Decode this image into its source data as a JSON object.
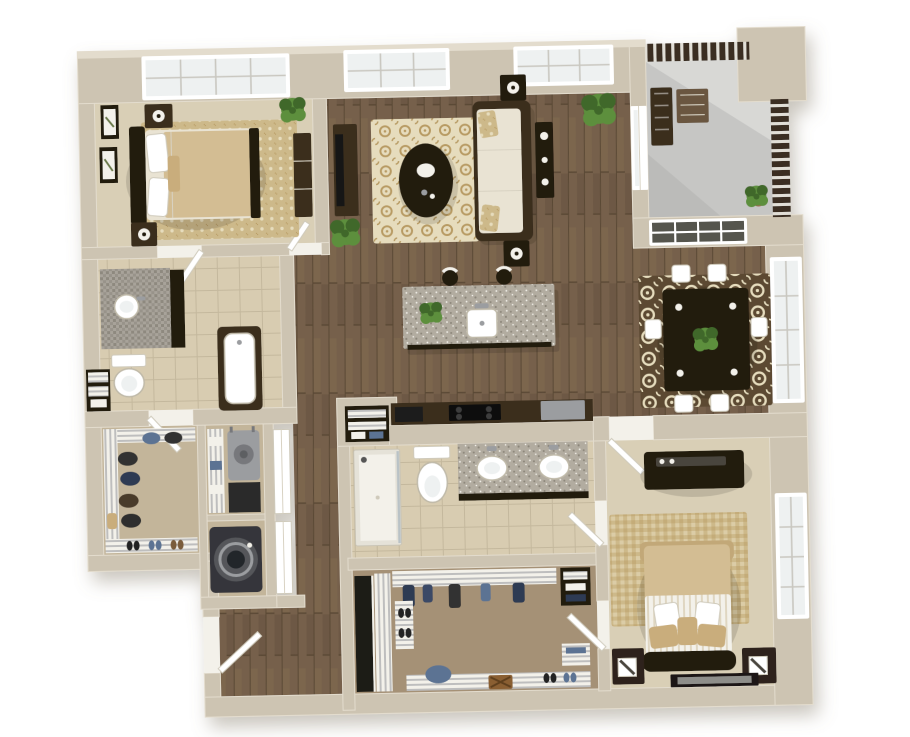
{
  "scene": {
    "type": "3d-floor-plan-render",
    "description": "Top-down 3D render of a two-bedroom, two-bathroom apartment with open living/kitchen/dining area, balcony, walk-in closets and laundry",
    "background": "#ffffff"
  },
  "palette": {
    "wall": "#cdc4b2",
    "wall-light": "#e3dccd",
    "wall-dark": "#a89e8a",
    "wood": "#76614b",
    "wood-dark": "#5a4835",
    "wood-light": "#8b7456",
    "carpet": "#d9cfb6",
    "carpet-2": "#c3b59a",
    "closet-floor": "#a59176",
    "tile": "#d8ccb1",
    "tile-line": "#c4b89d",
    "mosaic-1": "#a8a39a",
    "mosaic-2": "#8e897f",
    "granite": "#b2aca0",
    "granite-dot": "#8c867a",
    "rug-gold": "#cdb98a",
    "rug-cream": "#e6dcbd",
    "rug-brown": "#5c4a31",
    "rug-accent": "#b89b63",
    "sofa-cream": "#e9e3d3",
    "furniture-dark": "#3a2d1f",
    "furniture-darker": "#221a10",
    "plant": "#5d8f3d",
    "plant-dark": "#41682a",
    "balcony-floor": "#c6c6c4",
    "railing": "#3a2f23",
    "white": "#ffffff",
    "off-white": "#f3f1ea",
    "glass": "#eef1f1",
    "glass-dark": "#55544e",
    "steel": "#9b9da0",
    "navy": "#2e3a52",
    "denim": "#5b7393",
    "tan-1": "#d3bd93",
    "tan-2": "#c2a878",
    "tan-3": "#c9ad7c",
    "terracotta": "#9c6b4f",
    "wood-tone": "#6b573f",
    "shadow": "#8a8170"
  },
  "rooms": {
    "bedroom1": {
      "name": "Bedroom 1",
      "floor": "carpet",
      "items": [
        "bed",
        "headboard",
        "pillows",
        "area-rug",
        "nightstand",
        "table-lamp",
        "dresser",
        "wall-art",
        "potted-plant",
        "window"
      ]
    },
    "living": {
      "name": "Living Room",
      "floor": "hardwood",
      "items": [
        "sofa",
        "accent-pillows",
        "coffee-table",
        "console-table",
        "end-table",
        "tv-console",
        "tv",
        "area-rug",
        "potted-plant",
        "window",
        "sliding-door"
      ]
    },
    "kitchen": {
      "name": "Kitchen",
      "floor": "hardwood",
      "items": [
        "island",
        "island-sink",
        "faucet",
        "bar-stool",
        "potted-plant",
        "counter",
        "cooktop",
        "refrigerator"
      ]
    },
    "dining": {
      "name": "Dining Area",
      "floor": "hardwood",
      "items": [
        "dining-table",
        "dining-chair",
        "centerpiece-plant",
        "area-rug",
        "window"
      ]
    },
    "balcony": {
      "name": "Balcony",
      "floor": "concrete",
      "items": [
        "railing",
        "bench",
        "side-table",
        "potted-plant"
      ]
    },
    "bathroom1": {
      "name": "Bathroom 1",
      "floor": "tile",
      "items": [
        "vanity",
        "vessel-sink",
        "toilet",
        "bathtub",
        "linen-shelves",
        "door"
      ]
    },
    "walkInCloset1": {
      "name": "Walk-in Closet 1",
      "floor": "carpet",
      "items": [
        "wire-shelves",
        "hanging-clothes",
        "shoe-shelf",
        "towels",
        "door"
      ]
    },
    "utility": {
      "name": "Utility Closet",
      "floor": "carpet",
      "items": [
        "water-heater",
        "wire-shelves",
        "towels",
        "bifold-door"
      ]
    },
    "laundry": {
      "name": "Laundry Closet",
      "floor": "carpet",
      "items": [
        "washer",
        "bifold-door"
      ]
    },
    "hallway": {
      "name": "Hallway",
      "floor": "hardwood",
      "items": [
        "door"
      ]
    },
    "entry": {
      "name": "Entry",
      "floor": "hardwood",
      "items": [
        "front-door"
      ]
    },
    "bathroom2": {
      "name": "Bathroom 2",
      "floor": "tile",
      "items": [
        "double-vanity",
        "vessel-sink",
        "toilet",
        "shower",
        "pantry-shelves",
        "door"
      ]
    },
    "walkInCloset2": {
      "name": "Walk-in Closet 2",
      "floor": "carpet",
      "items": [
        "wardrobe",
        "wire-shelves",
        "hanging-clothes",
        "shoe-shelf",
        "basket",
        "stool",
        "linen-cubby",
        "door"
      ]
    },
    "bedroom2": {
      "name": "Bedroom 2",
      "floor": "carpet",
      "items": [
        "bed",
        "headboard",
        "footboard-bench",
        "pillows",
        "striped-blanket",
        "area-rug",
        "media-chest",
        "nightstand",
        "table-lamp",
        "floor-frame",
        "window",
        "door"
      ]
    }
  }
}
